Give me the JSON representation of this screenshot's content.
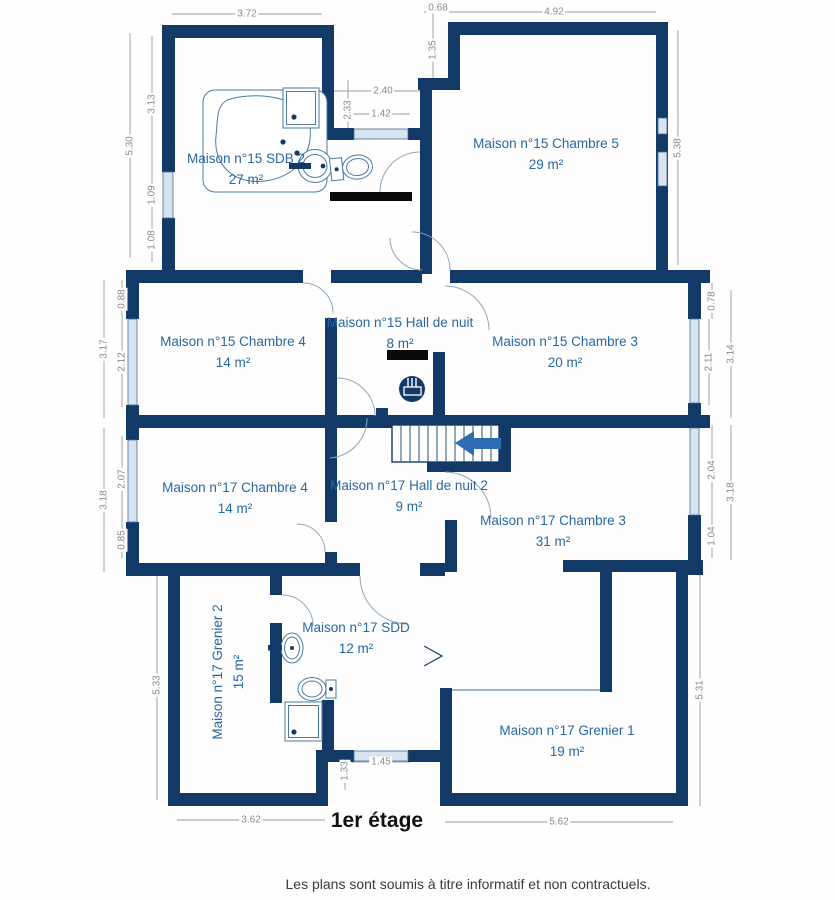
{
  "meta": {
    "floor_label": "1er étage",
    "disclaimer": "Les plans sont soumis à titre informatif et non contractuels.",
    "type": "floor-plan"
  },
  "colors": {
    "wall": "#133a67",
    "room_text": "#2767a3",
    "dimension_text": "#8a8a8a",
    "window": "#d7e3ee",
    "stairs_arrow": "#2e6cb3",
    "floor_title_text": "#111111"
  },
  "rooms": [
    {
      "name": "Maison n°15 SDB 2",
      "area": "27 m²"
    },
    {
      "name": "Maison n°15 Chambre 5",
      "area": "29 m²"
    },
    {
      "name": "Maison n°15 Chambre 4",
      "area": "14 m²"
    },
    {
      "name": "Maison n°15 Hall de nuit",
      "area": "8 m²"
    },
    {
      "name": "Maison n°15 Chambre 3",
      "area": "20 m²"
    },
    {
      "name": "Maison n°17 Chambre 4",
      "area": "14 m²"
    },
    {
      "name": "Maison n°17 Hall de nuit 2",
      "area": "9 m²"
    },
    {
      "name": "Maison n°17 Chambre 3",
      "area": "31 m²"
    },
    {
      "name": "Maison n°17 Grenier 2",
      "area": "15 m²"
    },
    {
      "name": "Maison n°17 SDD",
      "area": "12 m²"
    },
    {
      "name": "Maison n°17 Grenier 1",
      "area": "19 m²"
    }
  ],
  "dims": {
    "t1": "3.72",
    "t2": "0.68",
    "t3": "4.92",
    "t4": "1.35",
    "t5": "2.33",
    "t6": "2.40",
    "t7": "1.42",
    "l1": "5.30",
    "l2": "3.13",
    "l3": "1.09",
    "l4": "1.08",
    "l5": "3.17",
    "l6": "0.88",
    "l7": "2.12",
    "l8": "3.18",
    "l9": "2.07",
    "l10": "0.85",
    "l11": "5.33",
    "r1": "5.38",
    "r2": "0.78",
    "r3": "2.11",
    "r4": "3.14",
    "r5": "2.04",
    "r6": "1.04",
    "r7": "3.18",
    "r8": "5.31",
    "b1": "3.62",
    "b2": "1.33",
    "b3": "1.45",
    "b4": "5.62"
  },
  "icons": [
    "bathtub-icon",
    "shower-icon",
    "sink-icon",
    "toilet-icon",
    "radiator-icon",
    "stairs-icon",
    "arrow-left-icon"
  ]
}
